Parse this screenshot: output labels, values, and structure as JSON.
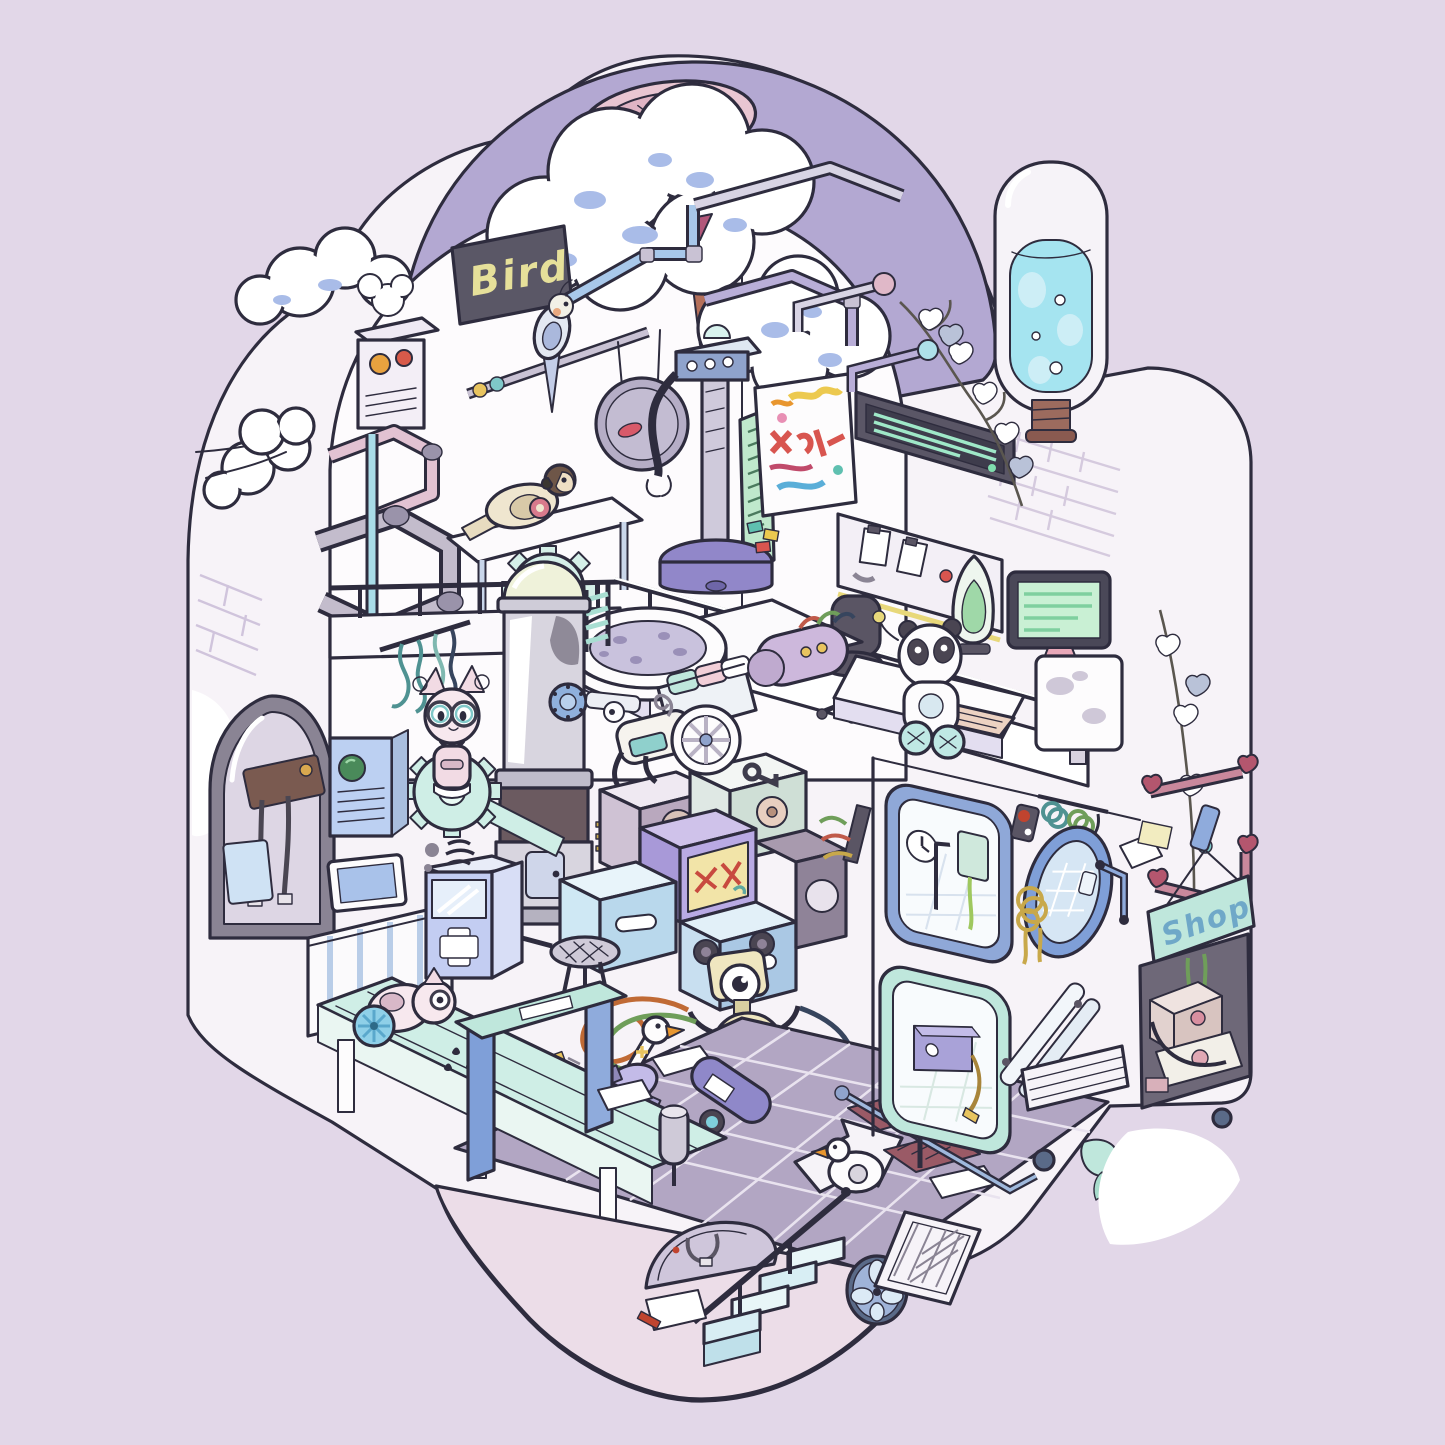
{
  "artwork": {
    "type": "isometric-cutaway-illustration",
    "signs": {
      "bird_sign": "Bird",
      "shop_sign": "Shop"
    },
    "palette": {
      "background": "#e2d7e8",
      "outline": "#2e2c3e",
      "wall_white": "#f7f3f8",
      "interior_white": "#fdfbfd",
      "dome_purple": "#b3a8d2",
      "vent_pink": "#e9c6d2",
      "mint": "#c5ebe1",
      "conveyor_mint": "#cfeee6",
      "water_blue": "#a5e4f0",
      "steel_blue": "#8fa8d8",
      "tile_floor": "#b2a6c3",
      "basement_pink": "#ecdde8",
      "accent_purple": "#9187c9",
      "screen_green": "#c9f0d4",
      "sticker_yellow": "#f2e4a8",
      "heart_pink": "#c9889c"
    },
    "entities": [
      "bird-chalkboard-sign",
      "cockatiel-on-perch",
      "swing-disc",
      "parrot-on-table",
      "radio-box",
      "smoke-cloud",
      "zigzag-pipes",
      "water-pipes",
      "gear-wheel",
      "robot-arm-tower",
      "graffiti-canvas",
      "led-ticker",
      "pegboard-workbench",
      "office-chair",
      "panda-robot",
      "green-monitor",
      "white-monitor",
      "keyboard",
      "lava-lamp",
      "loft-railing",
      "bathtub",
      "towel-basket",
      "capsule-machine",
      "boiler-column",
      "noodle-cables",
      "cat-robot-on-gear",
      "ac-panel",
      "tv-screen",
      "radiator",
      "medical-cabinet",
      "machine-cubes",
      "wheel-robot",
      "dog-robot",
      "cable-bundle",
      "strainer",
      "tiled-floor",
      "floor-arrow",
      "floor-vents",
      "paper-sheets",
      "handrail",
      "rabbit-robot",
      "goose-robot",
      "duck-robot",
      "hair-dryer",
      "flashlight",
      "feather-duster",
      "wash-gate",
      "conveyor-table",
      "belt-cat-robot",
      "roll-holder",
      "basement-arch-window",
      "staircase",
      "stair-railing",
      "exhaust-fan",
      "mesh-grille",
      "note-paper",
      "shower-niche-clock",
      "shower-niche-heater",
      "red-button",
      "wall-mirror",
      "hook-cables",
      "fluorescent-tubes",
      "striped-vent",
      "grab-handle",
      "towel-bars",
      "shop-sign",
      "shop-shelf-boxes",
      "ivy-leaves",
      "brick-wall",
      "arched-window",
      "plug-cables",
      "window-pane",
      "tree-canopy",
      "tree-trunk",
      "clouds",
      "dome-vent",
      "water-capsule",
      "snow-patches",
      "wall-lamp",
      "splash-faucet"
    ]
  }
}
